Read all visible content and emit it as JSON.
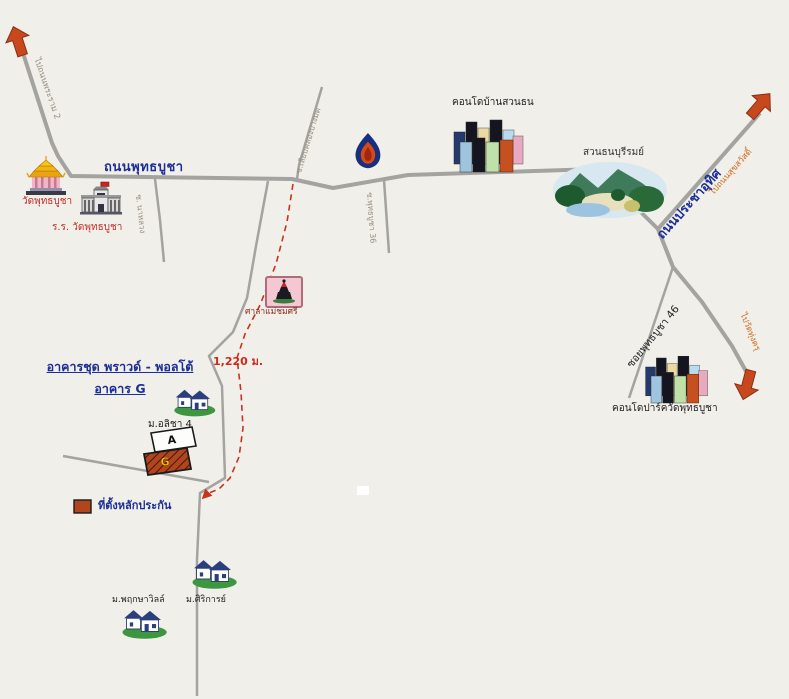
{
  "map": {
    "roads": {
      "phutthabucha_label": "ถนนพุทธบูชา",
      "prachauthit_label": "ถนนประชาอุทิศ",
      "soi46_label": "ซอยพุทธบูชา 46",
      "soi_west_label": "ซ. นาหลวง",
      "soi_stub_label": "ซ.พุทธบูชา 36",
      "soi_north_label": "ซ.เลียบคลองบางมด",
      "to_rama2_label": "ไปถนนพระราม 2",
      "to_suksawat_label": "ไปถนนสุขสวัสดิ์",
      "to_wat_thungkhru_label": "ไปวัดทุ่งครุ"
    },
    "places": {
      "temple_label": "วัดพุทธบูชา",
      "school_label": "ร.ร. วัดพุทธบูชา",
      "condo_baan_suan_thon_label": "คอนโดบ้านสวนธน",
      "park_label": "สวนธนบุรีรมย์",
      "shrine_label": "ศาลาแม่ชมศรี",
      "condo_park_label": "คอนโดปาร์ควัดพุทธบูชา",
      "village_alicha_label": "ม.อลิชา 4",
      "village_pruksa_ville_label": "ม.พฤกษาวิลล์",
      "village_sirikan_label": "ม.ศิริการย์"
    },
    "project": {
      "title_line1": "อาคารชุด พราวด์ - พอลโต้",
      "title_line2": "อาคาร G",
      "building_a_label": "A",
      "building_g_label": "G",
      "distance_label": "1,220 ม."
    },
    "legend": {
      "collateral_label": "ที่ตั้งหลักประกัน"
    },
    "colors": {
      "background": "#f0efea",
      "road_gray": "#a3a3a0",
      "road_name_blue": "#1c2f96",
      "place_red": "#c03025",
      "direction_orange": "#cf6a1e",
      "route_dash_red": "#c8331e",
      "arrow_red": "#c8481e",
      "collateral_brown": "#b0461e",
      "building_g_letter_yellow": "#f2c41a"
    },
    "icons": {
      "temple": "temple-icon",
      "school": "school-icon",
      "shrine": "shrine-icon",
      "gas_station": "ptt-flame-icon",
      "park": "park-icon",
      "condo": "condo-towers-icon",
      "houses": "houses-icon",
      "arrow": "direction-arrow-icon"
    }
  }
}
